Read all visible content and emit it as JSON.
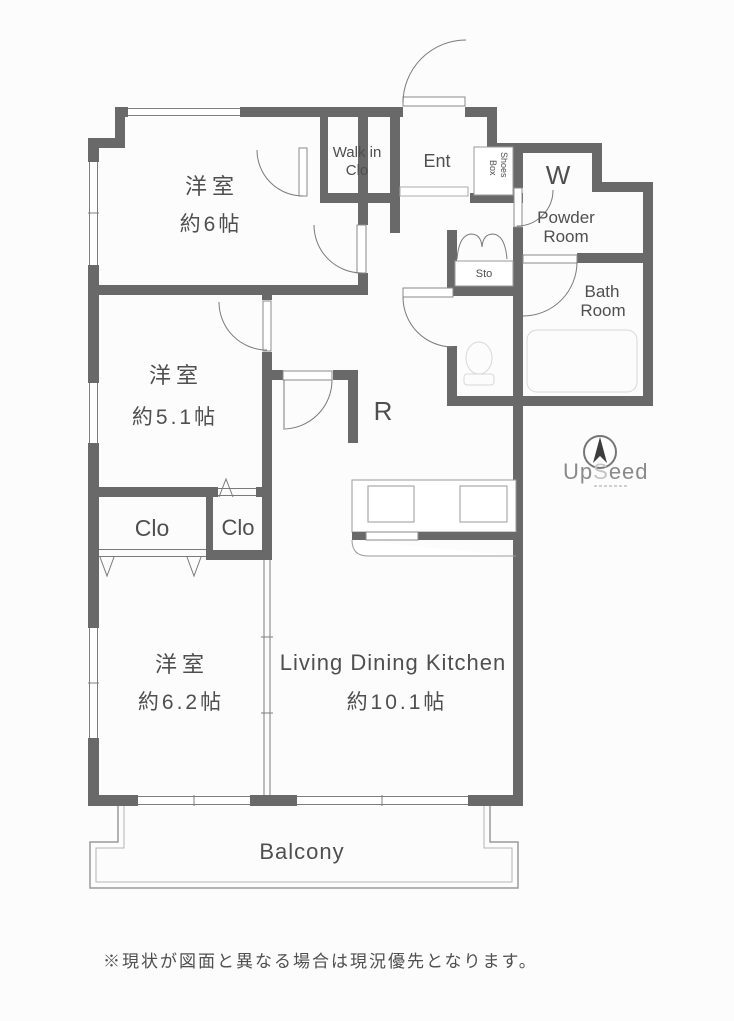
{
  "labels": {
    "bedroom1_name": "洋室",
    "bedroom1_size": "約6帖",
    "bedroom2_name": "洋室",
    "bedroom2_size": "約5.1帖",
    "bedroom3_name": "洋室",
    "bedroom3_size": "約6.2帖",
    "ldk_name": "Living Dining Kitchen",
    "ldk_size": "約10.1帖",
    "walkin_closet_line1": "Walk in",
    "walkin_closet_line2": "Clo",
    "entrance": "Ent",
    "shoes_box_line1": "Shoes",
    "shoes_box_line2": "Box",
    "washer": "W",
    "powder_room_line1": "Powder",
    "powder_room_line2": "Room",
    "bath_room_line1": "Bath",
    "bath_room_line2": "Room",
    "storage": "Sto",
    "refrigerator": "R",
    "closet_left": "Clo",
    "closet_right": "Clo",
    "balcony": "Balcony"
  },
  "logo": {
    "up": "Up",
    "s": "S",
    "eed": "eed"
  },
  "disclaimer": "※現状が図面と異なる場合は現況優先となります。",
  "colors": {
    "wall": "#696969",
    "line": "#7a7a7a",
    "text": "#4f4f4f",
    "faint_fixture": "#d8d8d8",
    "background": "#fcfcfc"
  }
}
